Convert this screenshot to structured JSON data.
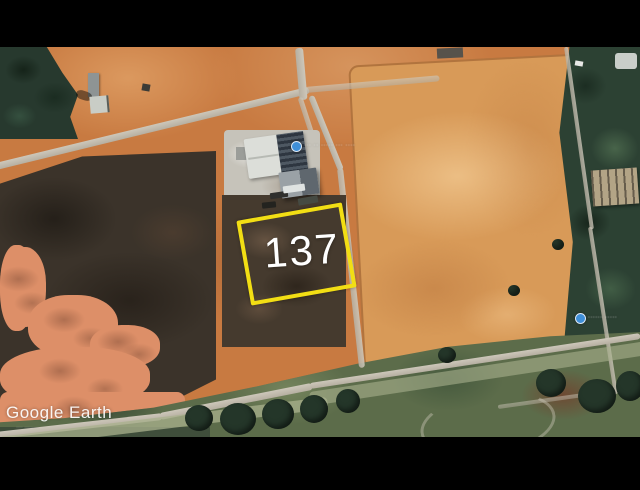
{
  "plot": {
    "number": "137"
  },
  "watermark": {
    "brand": "Google Earth",
    "fine_print": "∙∙∙∙ ∙∙∙∙∙"
  },
  "place_labels": {
    "building": "∙∙∙ ∙∙ ∙∙∙∙∙ ∙∙∙ ∙∙∙∙",
    "right_edge": "∙∙∙∙∙∙ ∙∙∙∙∙"
  },
  "colors": {
    "plot_outline": "#f2de14",
    "plot_label": "#ffffff",
    "pin_blue": "#3f8fd8",
    "letterbox": "#000000",
    "dirt_orange": "#c87a41",
    "sand_light": "#d89a58",
    "scrub_dark": "#3b332a",
    "trees_green": "#2c4133",
    "road_gray": "#c6bfb1",
    "grass_green": "#5c6c4a"
  }
}
